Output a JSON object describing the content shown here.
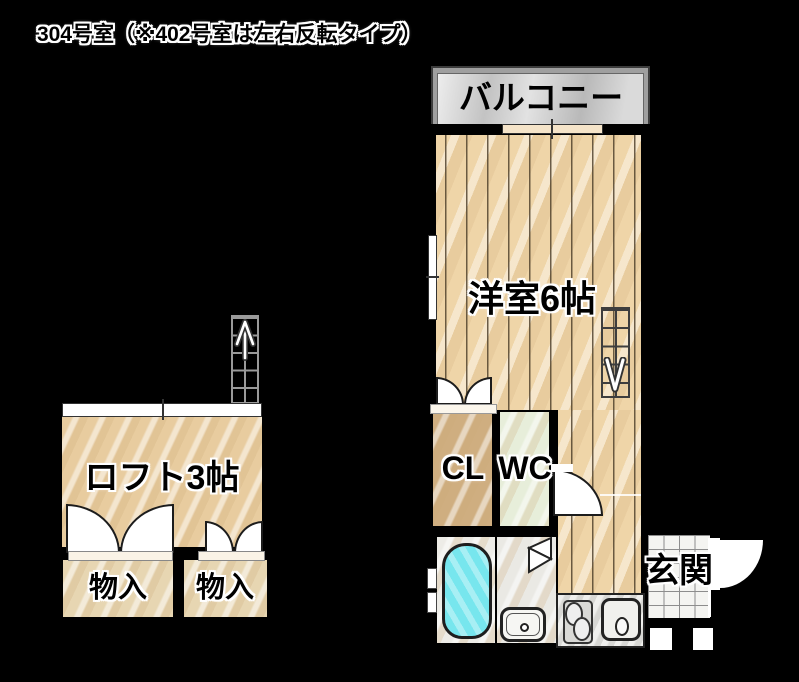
{
  "title": "304号室（※402号室は左右反転タイプ）",
  "rooms": {
    "balcony": {
      "label": "バルコニー"
    },
    "western_room": {
      "label": "洋室6帖"
    },
    "closet": {
      "label": "CL"
    },
    "toilet": {
      "label": "WC"
    },
    "loft": {
      "label": "ロフト3帖"
    },
    "storage_left": {
      "label": "物入"
    },
    "storage_right": {
      "label": "物入"
    },
    "entrance": {
      "label": "玄関"
    }
  },
  "colors": {
    "background": "#000000",
    "wood_floor": "#efd5a8",
    "loft_floor": "#e8cc9f",
    "closet_floor": "#cfae80",
    "storage_floor": "#e7d6b2",
    "toilet_floor": "#e7eeda",
    "bath_floor": "#edece7",
    "bathtub": "#79e7ee",
    "balcony": "#d2d2d2",
    "entrance_tile": "#f4f4f1"
  }
}
